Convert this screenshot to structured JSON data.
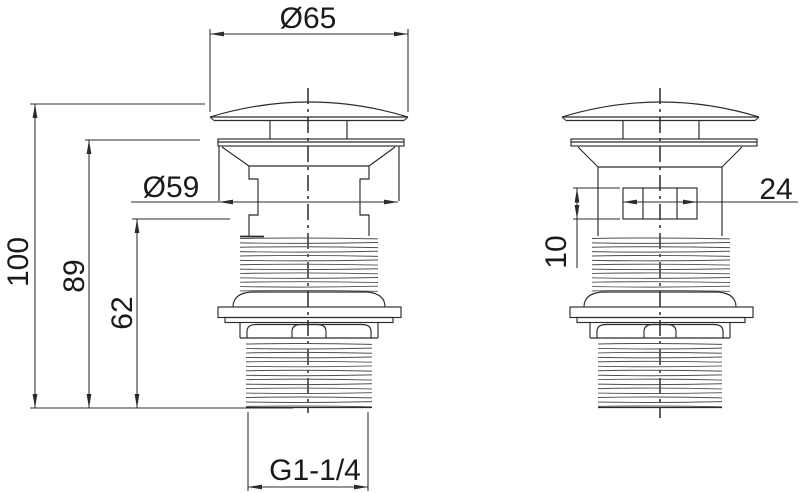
{
  "dimensions": {
    "cap_diameter": "Ø65",
    "body_diameter": "Ø59",
    "total_height": "100",
    "height_to_flange": "89",
    "lower_section_height": "62",
    "outlet_thread": "G1-1/4",
    "slot_width": "24",
    "slot_height": "10"
  },
  "colors": {
    "line": "#2b2b2b",
    "thread": "#4f4f4f",
    "text": "#1a1a1a",
    "background": "#ffffff"
  }
}
